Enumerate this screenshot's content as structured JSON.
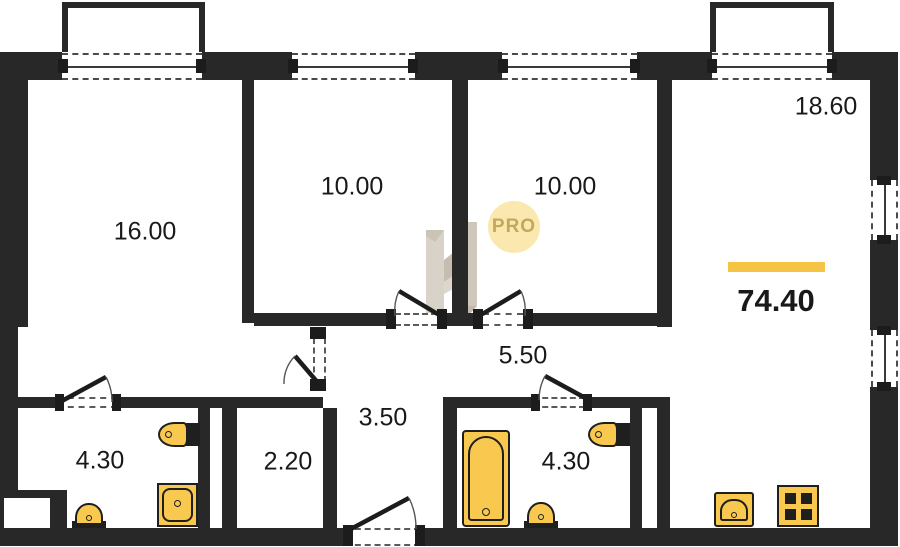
{
  "plan": {
    "watermark": {
      "badge": "PRO"
    },
    "total_area": "74.40",
    "rooms": [
      {
        "name": "room-1",
        "area": "16.00"
      },
      {
        "name": "room-2",
        "area": "10.00"
      },
      {
        "name": "room-3",
        "area": "10.00"
      },
      {
        "name": "kitchen-living",
        "area": "18.60"
      },
      {
        "name": "hallway",
        "area": "5.50"
      },
      {
        "name": "corridor",
        "area": "3.50"
      },
      {
        "name": "corridor-2",
        "area": "2.20"
      },
      {
        "name": "bathroom-left",
        "area": "4.30"
      },
      {
        "name": "bathroom-right",
        "area": "4.30"
      }
    ],
    "icons": {
      "bathtub": "bathtub-icon",
      "toilet": "toilet-icon",
      "sink": "sink-icon",
      "washing_machine": "washing-machine-icon",
      "stove": "stove-icon",
      "kitchen_sink": "kitchen-sink-icon"
    },
    "colors": {
      "wall": "#282828",
      "fixture_fill": "#F9C84F",
      "accent_bar": "#F6C445",
      "badge_bg": "#FBE8AE",
      "badge_text": "#C3A75D",
      "watermark": "#D7D0C6"
    }
  }
}
